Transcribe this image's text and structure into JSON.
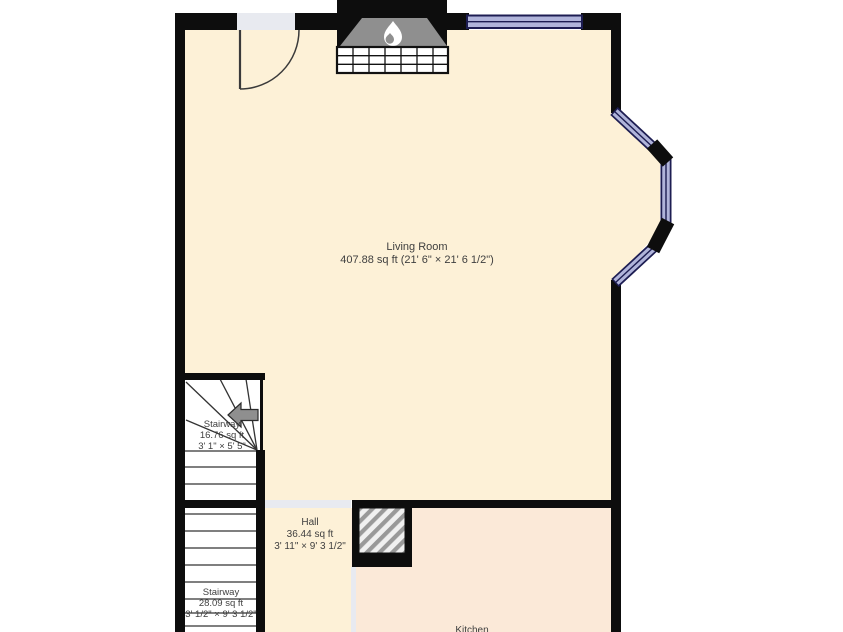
{
  "plan": {
    "title": "First floor plan",
    "rooms": [
      {
        "id": "living-room",
        "name": "Living Room",
        "area_dims": "407.88 sq ft (21' 6\" × 21' 6 1/2\")"
      },
      {
        "id": "stairway-upper",
        "name": "Stairway",
        "area": "16.76 sq ft",
        "dims": "3' 1\" × 5' 5\""
      },
      {
        "id": "hall",
        "name": "Hall",
        "area": "36.44 sq ft",
        "dims": "3' 11\" × 9' 3 1/2\""
      },
      {
        "id": "stairway-lower",
        "name": "Stairway",
        "area": "28.09 sq ft",
        "dims": "3' 1/2\" × 9' 3 1/2\""
      },
      {
        "id": "kitchen",
        "name": "Kitchen"
      }
    ],
    "icons": {
      "fireplace": "flame-icon",
      "stairs": "stair-direction-arrow-icon"
    },
    "colors": {
      "wall": "#0d0d0d",
      "room_fill": "#fdf1d7",
      "kitchen_fill": "#fbe9d8",
      "stair_fill": "#ffffff",
      "window_fill": "#b0b4da",
      "window_frame": "#1d1d52",
      "threshold": "#e8eaf0",
      "hatch_stripe": "#999999",
      "fireplace_inner": "#8f8f8f",
      "label_text": "#3f3f3f"
    }
  }
}
